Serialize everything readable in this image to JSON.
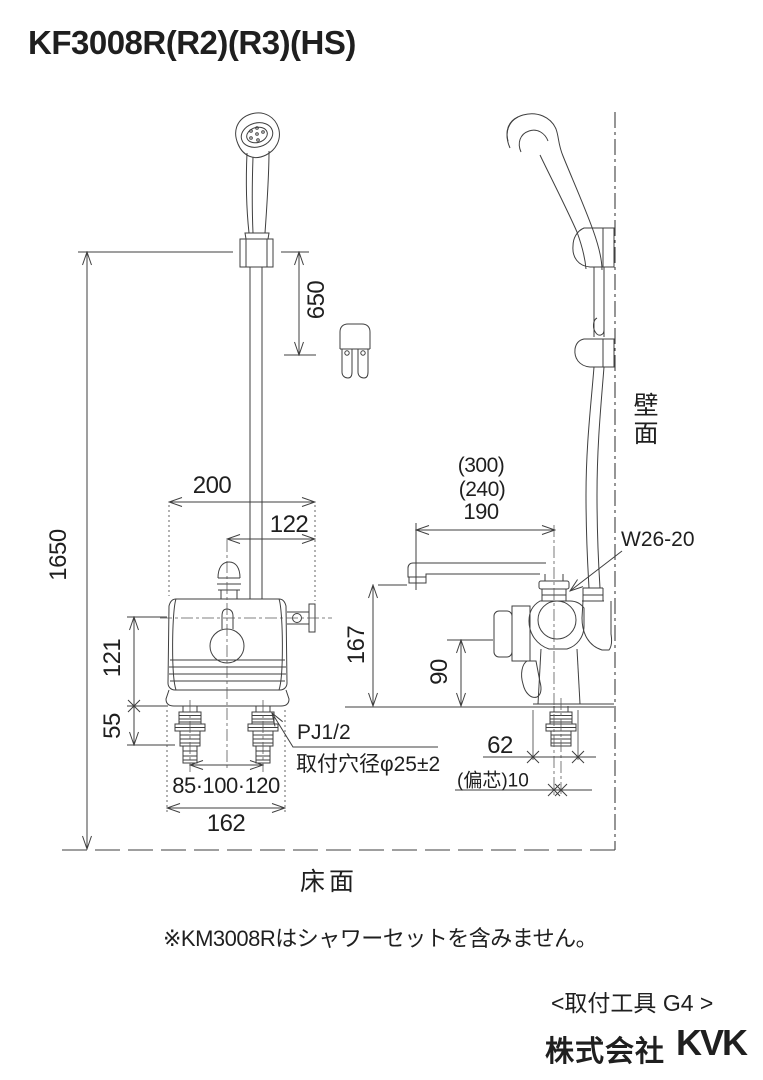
{
  "title": "KF3008R(R2)(R3)(HS)",
  "front": {
    "dim_1650": "1650",
    "dim_650": "650",
    "dim_200": "200",
    "dim_122": "122",
    "dim_121": "121",
    "dim_55": "55",
    "dim_pitch": "85·100·120",
    "dim_162": "162",
    "label_pj": "PJ1/2",
    "label_hole": "取付穴径φ25±2"
  },
  "side": {
    "dim_300": "(300)",
    "dim_240": "(240)",
    "dim_190": "190",
    "label_w26": "W26-20",
    "dim_167": "167",
    "dim_90": "90",
    "dim_62": "62",
    "dim_eccentric": "(偏芯)10",
    "label_wall": "壁面"
  },
  "label_floor": "床面",
  "note": "※KM3008Rはシャワーセットを含みません。",
  "tool_label": "<取付工具 G4 >",
  "company": {
    "prefix": "株式会社",
    "logo": "KVK"
  },
  "colors": {
    "line": "#3f3f3f",
    "text": "#1f1f1f",
    "background": "#ffffff"
  }
}
